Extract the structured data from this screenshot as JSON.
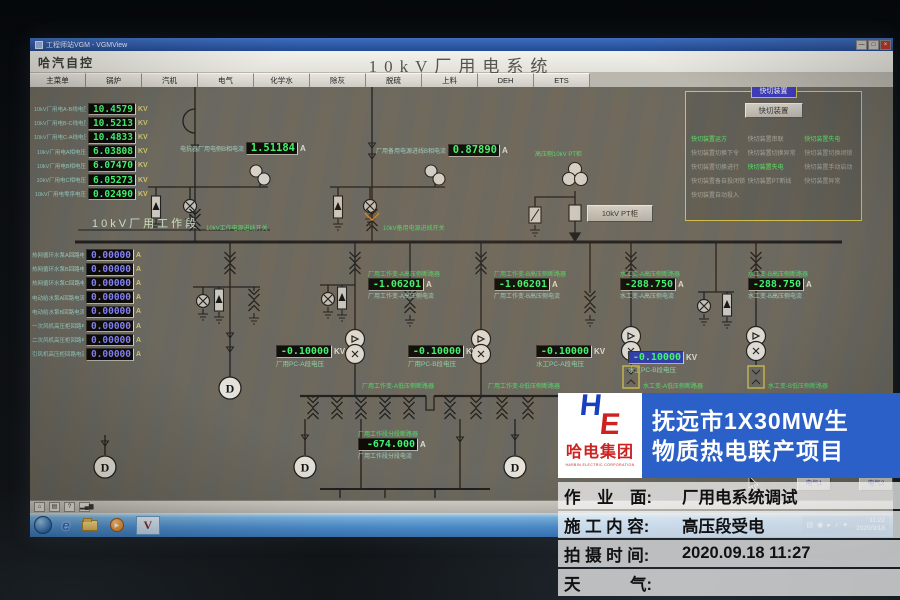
{
  "window": {
    "title": "工程师站VGM - VGMView",
    "app_name": "哈汽自控",
    "page_title": "10kV厂用电系统",
    "buttons": {
      "minimize": "—",
      "maximize": "□",
      "close": "×"
    }
  },
  "menu": {
    "tabs": [
      "主菜单",
      "锅炉",
      "汽机",
      "电气",
      "化学水",
      "除灰",
      "脱硫",
      "上料",
      "DEH",
      "ETS"
    ]
  },
  "voltage_list": [
    {
      "label": "10kV厂用电A-B线电压",
      "value": "10.4579",
      "unit": "KV"
    },
    {
      "label": "10kV厂用电B-C线电压",
      "value": "10.5213",
      "unit": "KV"
    },
    {
      "label": "10kV厂用电C-A线电压",
      "value": "10.4833",
      "unit": "KV"
    },
    {
      "label": "10kV厂用电A相电压",
      "value": "6.03808",
      "unit": "KV"
    },
    {
      "label": "10kV厂用电B相电压",
      "value": "6.07470",
      "unit": "KV"
    },
    {
      "label": "10kV厂用电C相电压",
      "value": "6.05273",
      "unit": "KV"
    },
    {
      "label": "10kV厂用电零序电压",
      "value": "0.02490",
      "unit": "KV"
    }
  ],
  "current_list": [
    {
      "label": "热网循环水泵A回路电流",
      "value": "0.00000",
      "unit": "A"
    },
    {
      "label": "热网循环水泵B回路电流",
      "value": "0.00000",
      "unit": "A"
    },
    {
      "label": "热网循环水泵C回路电流",
      "value": "0.00000",
      "unit": "A"
    },
    {
      "label": "电动给水泵A回路电流",
      "value": "0.00000",
      "unit": "A"
    },
    {
      "label": "电动给水泵B回路电流",
      "value": "0.00000",
      "unit": "A"
    },
    {
      "label": "一次风机高压柜回路电流",
      "value": "0.00000",
      "unit": "A"
    },
    {
      "label": "二次风机高压柜回路电流",
      "value": "0.00000",
      "unit": "A"
    },
    {
      "label": "引风机高压柜回路电流",
      "value": "0.00000",
      "unit": "A"
    }
  ],
  "kuaiqie": {
    "title": "快切装置",
    "button": "快切装置",
    "statuses": [
      {
        "label": "快切装置运方",
        "color": "#55ee66"
      },
      {
        "label": "快切装置串联",
        "color": "#a9a9a0"
      },
      {
        "label": "快切装置失电",
        "color": "#55ee66"
      },
      {
        "label": "快切装置切换下令",
        "color": "#a9a9a0"
      },
      {
        "label": "快切装置切换异常",
        "color": "#a9a9a0"
      },
      {
        "label": "快切装置切换闭锁",
        "color": "#a9a9a0"
      },
      {
        "label": "快切装置切换进行",
        "color": "#a9a9a0"
      },
      {
        "label": "快切装置失电",
        "color": "#55ee66"
      },
      {
        "label": "快切装置手动启动",
        "color": "#a9a9a0"
      },
      {
        "label": "快切装置备自投闭锁",
        "color": "#a9a9a0"
      },
      {
        "label": "快切装置PT断线",
        "color": "#a9a9a0"
      },
      {
        "label": "快切装置异常",
        "color": "#a9a9a0"
      },
      {
        "label": "快切装置自动投入",
        "color": "#a9a9a0"
      }
    ]
  },
  "diagram": {
    "bus_label": "10kV厂用工作段",
    "incoming_work": "10kV工作电源进线开关",
    "incoming_standby": "10kV备用电源进线开关",
    "pt_label": "高压侧10kV PT柜",
    "pt_button": "10kV PT柜",
    "reactor_current": {
      "label": "电抗器厂用电侧B相电流",
      "value": "1.51184",
      "unit": "A"
    },
    "standby_current": {
      "label": "厂用备用电源进线B相电流",
      "value": "0.87890",
      "unit": "A"
    },
    "tx_a": {
      "name": "厂用工作变-A高压侧断路器",
      "value": "-1.06201",
      "unit": "A",
      "current_label": "厂用工作变-A高压侧电流"
    },
    "tx_b": {
      "name": "厂用工作变-B高压侧断路器",
      "value": "-1.06201",
      "unit": "A",
      "current_label": "厂用工作变-B高压侧电流"
    },
    "water_a": {
      "name": "水工变-A高压侧断路器",
      "value": "-288.750",
      "unit": "A",
      "current_label": "水工变-A高压侧电流"
    },
    "water_b": {
      "name": "水工变-B高压侧断路器",
      "value": "-288.750",
      "unit": "A",
      "current_label": "水工变-B高压侧电流"
    },
    "pc_a": {
      "value": "-0.10000",
      "unit": "KV",
      "label": "厂用PC-A段电压"
    },
    "pc_b": {
      "value": "-0.10000",
      "unit": "KV",
      "label": "厂用PC-B段电压"
    },
    "water_pc_a": {
      "value": "-0.10000",
      "unit": "KV",
      "label": "水工PC-A段电压"
    },
    "water_pc_b": {
      "value": "-0.10000",
      "unit": "KV",
      "label": "水工PC-B段电压"
    },
    "tx_a_low": "厂用工作变-A低压侧断路器",
    "tx_b_low": "厂用工作变-B低压侧断路器",
    "water_a_low": "水工变-A低压侧断路器",
    "water_b_low": "水工变-B低压侧断路器",
    "section": {
      "name": "厂用工作段分段断路器",
      "value": "-674.000",
      "unit": "A",
      "current_label": "厂用工作段分段电流"
    },
    "hmi_buttons": [
      "电气1",
      "电气2"
    ]
  },
  "toolstrip_icons": [
    {
      "name": "home",
      "glyph": "⌂"
    },
    {
      "name": "printer",
      "glyph": "▤"
    },
    {
      "name": "help",
      "glyph": "?"
    },
    {
      "name": "signal",
      "glyph": "▂▄▆"
    }
  ],
  "taskbar": {
    "quick": [
      {
        "name": "internet-explorer",
        "glyph": "e"
      },
      {
        "name": "media-player",
        "glyph": "▶"
      },
      {
        "name": "vgm-view",
        "glyph": "V"
      }
    ],
    "tray_icons": [
      "▤",
      "◉",
      "▸",
      "♪",
      "✦"
    ],
    "time": "11:22",
    "date": "2020/9/18"
  },
  "overlay": {
    "logo_mark_h": "H",
    "logo_mark_e": "E",
    "logo_text": "哈电集团",
    "logo_sub": "HARBIN ELECTRIC CORPORATION",
    "project_line1": "抚远市1X30MW生",
    "project_line2": "物质热电联产项目",
    "rows": [
      {
        "label": "作　业　面:",
        "value": "厂用电系统调试"
      },
      {
        "label": "施 工 内 容:",
        "value": "高压段受电"
      },
      {
        "label": "拍 摄 时 间:",
        "value": "2020.09.18 11:27"
      },
      {
        "label": "天　　　气:",
        "value": ""
      }
    ]
  },
  "colors": {
    "hmi_bg": "#6b6960",
    "value_green": "#3dff72",
    "value_blue": "#8884ff",
    "unit_yellow": "#d6cb6a",
    "label_cyan": "#9fd8cc",
    "label_green": "#55e070",
    "panel_yellow": "#d8c84a",
    "overlay_blue": "#2a60c8",
    "logo_red": "#cc2222",
    "logo_blue": "#1a3fbf",
    "taskbar_blue": "#4e92d6",
    "status_green": "#55ee66"
  }
}
